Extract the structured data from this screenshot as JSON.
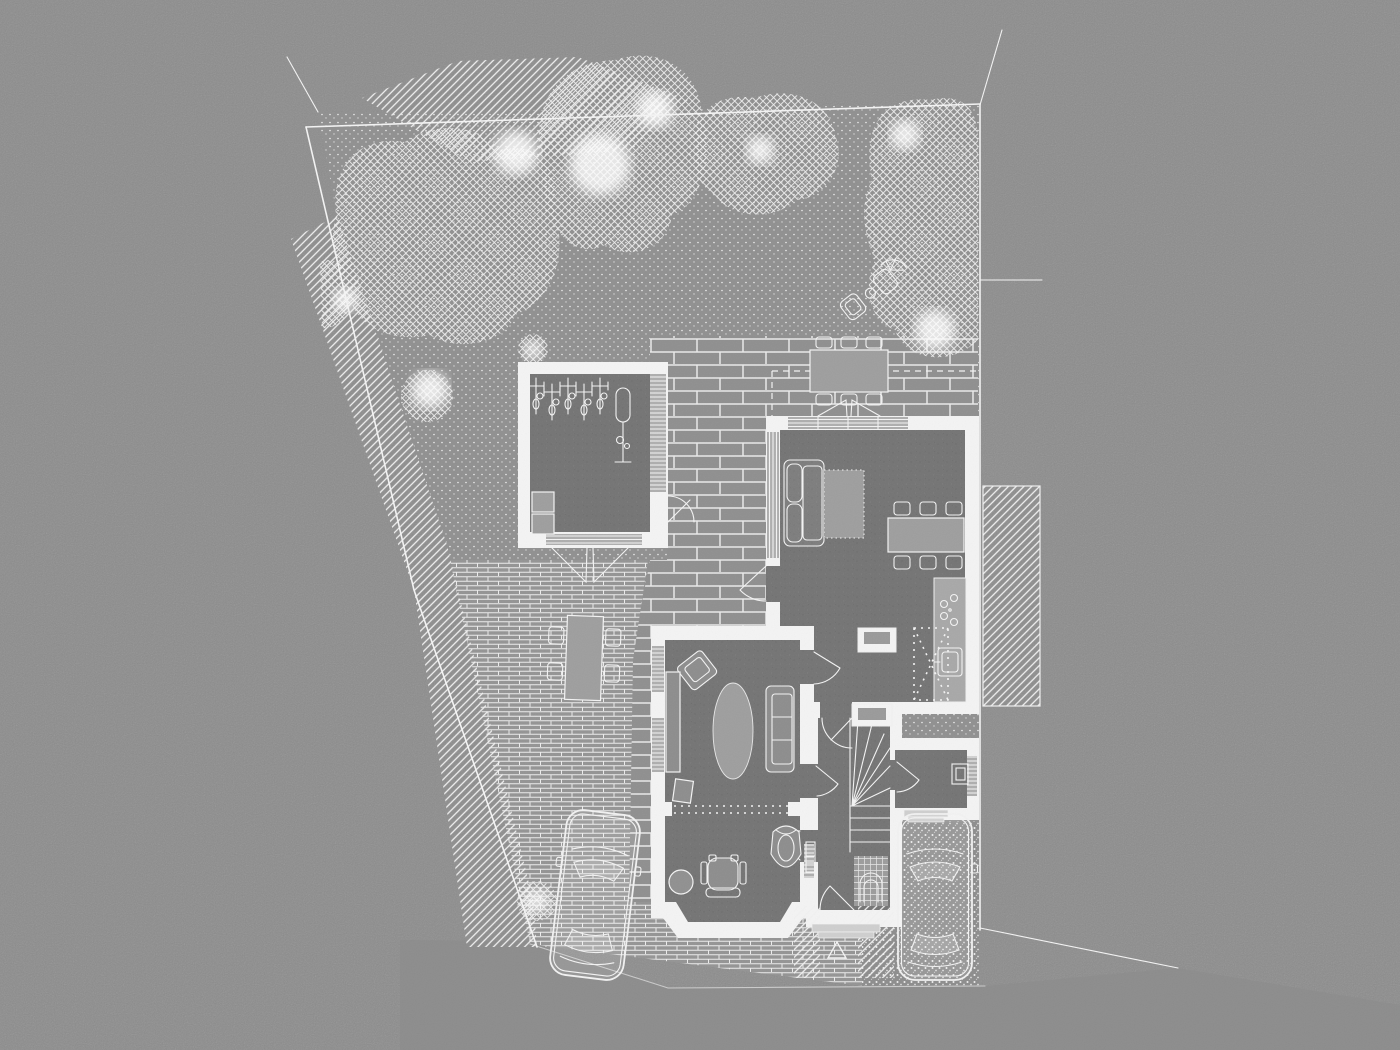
{
  "colors": {
    "paper": "#8c8c8c",
    "line": "#f4f4f4",
    "floor": "#747474",
    "paver": "#8f8f8f",
    "brick": "#949494",
    "lawn": "#909090",
    "gravel": "#8d8d8d",
    "furn": "#9e9e9e",
    "counter": "#a8a8a8",
    "glaz": "#aeaeae"
  },
  "scene": {
    "type": "architectural-site-plan-ground-floor",
    "style": "white linework and hatching on gray textured paper, no text labels",
    "site": {
      "boundary": "irregular quadrilateral plot outlined in white",
      "ground_textures": [
        "stippled lawn",
        "cross-hatched tree canopies",
        "diagonal-hatched boundary hedge",
        "large format paving",
        "small brick paving",
        "stippled gravel drive",
        "hatched neighbouring roof"
      ]
    },
    "garden": {
      "bike_store": {
        "bikes_in_rack": 5,
        "freestanding_bikes": 1,
        "storage_boxes": 2,
        "glazed_side": true,
        "folding_south_doors": true
      },
      "north_patio_table": {
        "chairs": 6
      },
      "west_patio_table": {
        "chairs": 4
      },
      "northeast_lounge_set": {
        "lounge_chairs": 2,
        "side_table": 1,
        "parasol": 1
      },
      "shrubs": 3,
      "canopy_dashed_overhang": true
    },
    "house": {
      "rooms": [
        {
          "name": "open-plan-living-kitchen-dining",
          "furniture": [
            "sofa",
            "dashed-rug",
            "dining-table-with-6-chairs",
            "kitchen-counter",
            "hob-4-rings",
            "sink",
            "dashed-island",
            "cabinet",
            "wall-cabinet"
          ]
        },
        {
          "name": "snug-lounge",
          "furniture": [
            "oval-rug",
            "wall-sofa",
            "armchair",
            "sideboard",
            "side-table"
          ]
        },
        {
          "name": "study-with-bay",
          "furniture": [
            "desk-chair",
            "round-stool",
            "lounge-chair"
          ]
        },
        {
          "name": "hallway",
          "furniture": [
            "winder-staircase",
            "radiator",
            "tiled-vestibule-with-arch"
          ]
        },
        {
          "name": "utility-room",
          "furniture": [
            "sink-unit"
          ]
        }
      ],
      "glazing": [
        "north sliding/folding doors",
        "west window strip",
        "snug west windows",
        "study bay glazing",
        "hall window",
        "utility window"
      ],
      "doors_with_swing_arcs": 8
    },
    "vehicles": {
      "cars_total": 2,
      "on_brick_drive": 1,
      "on_gravel_drive": 1
    },
    "markers": {
      "entrance_triangle": 1,
      "boundary_ticks": 3
    }
  }
}
